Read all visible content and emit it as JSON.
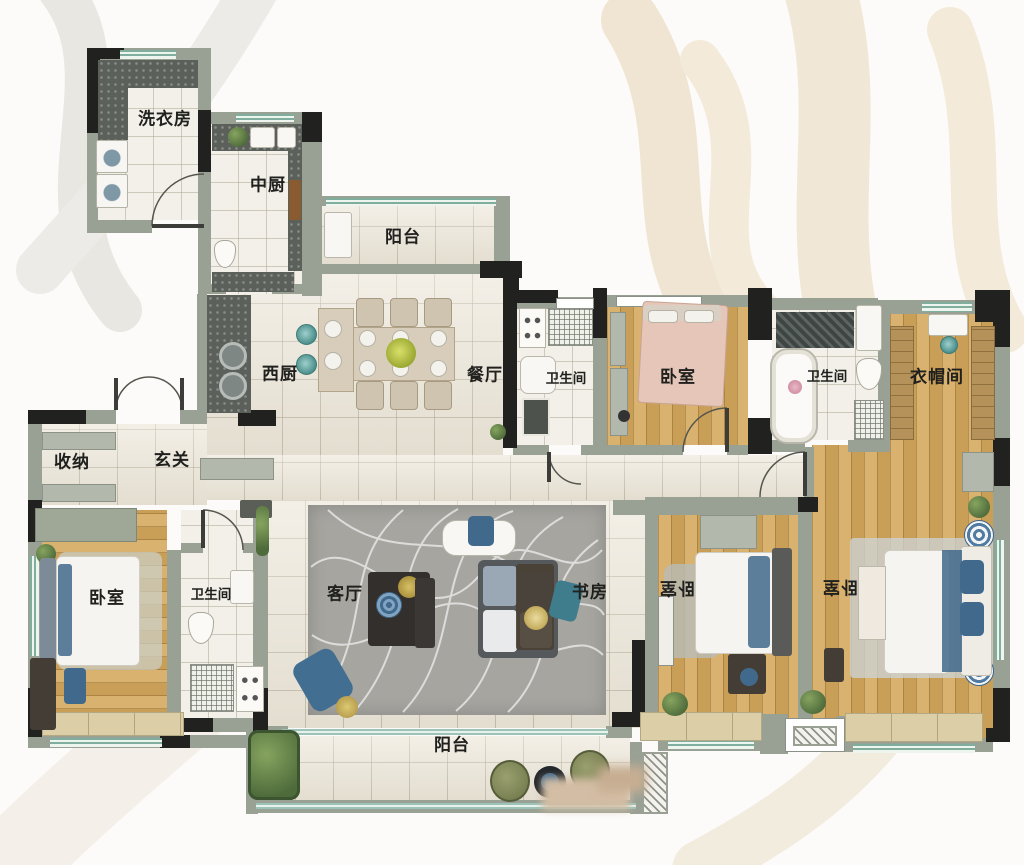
{
  "rooms": [
    {
      "id": "laundry",
      "label": "洗衣房"
    },
    {
      "id": "chinese_kitchen",
      "label": "中厨"
    },
    {
      "id": "north_balcony",
      "label": "阳台"
    },
    {
      "id": "western_kitchen",
      "label": "西厨"
    },
    {
      "id": "dining",
      "label": "餐厅"
    },
    {
      "id": "storage",
      "label": "收纳"
    },
    {
      "id": "foyer",
      "label": "玄关"
    },
    {
      "id": "bath_center",
      "label": "卫生间"
    },
    {
      "id": "bedroom_north",
      "label": "卧室"
    },
    {
      "id": "bath_master",
      "label": "卫生间"
    },
    {
      "id": "cloakroom",
      "label": "衣帽间"
    },
    {
      "id": "bedroom_west",
      "label": "卧室"
    },
    {
      "id": "bath_west",
      "label": "卫生间"
    },
    {
      "id": "living",
      "label": "客厅"
    },
    {
      "id": "study",
      "label": "书房"
    },
    {
      "id": "bedroom_south",
      "label": "卧室"
    },
    {
      "id": "bedroom_master",
      "label": "卧室"
    },
    {
      "id": "south_balcony",
      "label": "阳台"
    }
  ],
  "colors": {
    "wall": "#99a094",
    "structure": "#21221f",
    "marble_floor": "#ebe5d7",
    "tile_floor": "#f2f0e9",
    "wood_floor": "#d2a963",
    "rug": "#a6a5a0",
    "window_glass": "#7fae9f",
    "sill": "#dccfa8",
    "accent_blue": "#41698c",
    "teal": "#4b8f8c",
    "plant_green": "#4e6b3b",
    "bed_pink": "#e5c6b8",
    "label": "#20201e",
    "watermark_beige": "#f0e5d2",
    "watermark_grey": "#e9e7e2"
  }
}
